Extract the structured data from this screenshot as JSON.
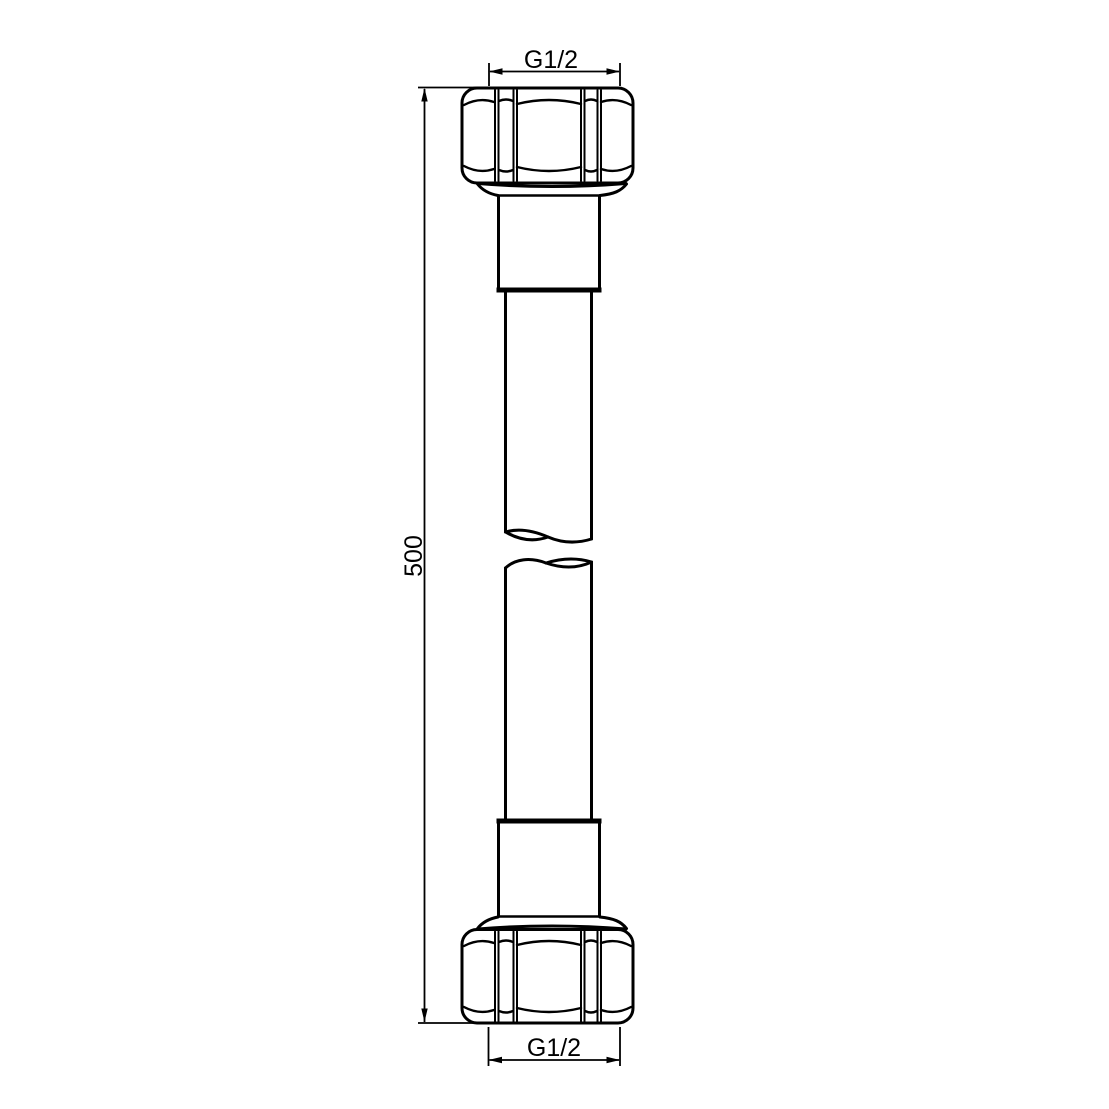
{
  "drawing": {
    "background_color": "#ffffff",
    "line_color": "#000000",
    "labels": {
      "top_thread": "G1/2",
      "hose_length": "500",
      "bottom_thread": "G1/2"
    }
  }
}
